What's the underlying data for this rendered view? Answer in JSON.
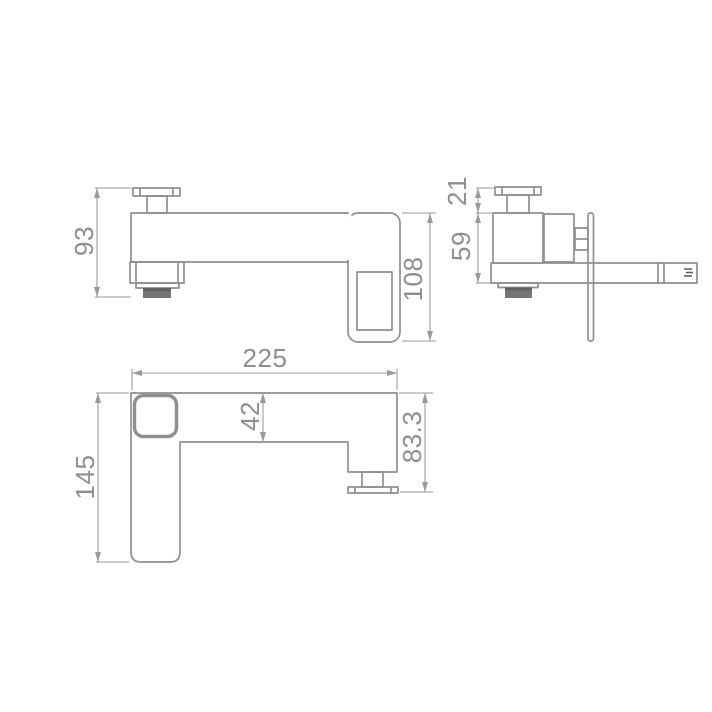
{
  "diagram": {
    "title": "faucet-technical-dimension-drawing",
    "colors": {
      "line": "#8f8f8f",
      "dim": "#9a9a9a",
      "text": "#8e8e8e",
      "dark": "#757575",
      "darker": "#626262",
      "background": "#ffffff"
    },
    "views": {
      "front": {
        "height": "93",
        "plate_height": "108"
      },
      "side": {
        "handle_height": "21",
        "body_height": "59"
      },
      "top": {
        "total_length": "225",
        "spout_bar_width": "42",
        "handle_section_length": "83.3",
        "spout_length": "145"
      }
    }
  }
}
